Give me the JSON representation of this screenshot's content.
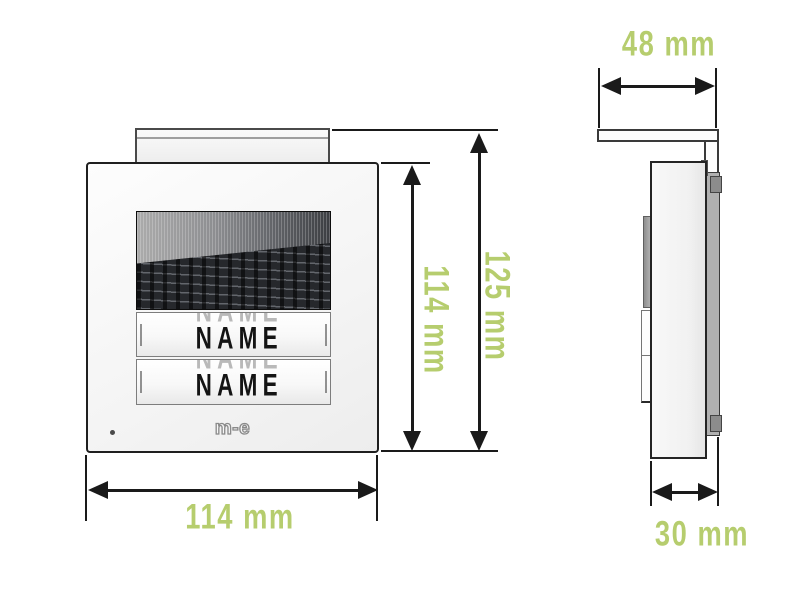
{
  "front_view": {
    "nameplates": [
      {
        "label": "NAME"
      },
      {
        "label": "NAME"
      }
    ],
    "brand_logo": "m-e"
  },
  "dimensions": {
    "side_depth_top": "48 mm",
    "front_total_height": "125 mm",
    "front_panel_height": "114 mm",
    "front_width": "114 mm",
    "side_depth_bottom": "30 mm"
  },
  "colors": {
    "dimension_label": "#b6cd6e",
    "line": "#1a1a1a",
    "speaker_dark": "#26282c"
  }
}
